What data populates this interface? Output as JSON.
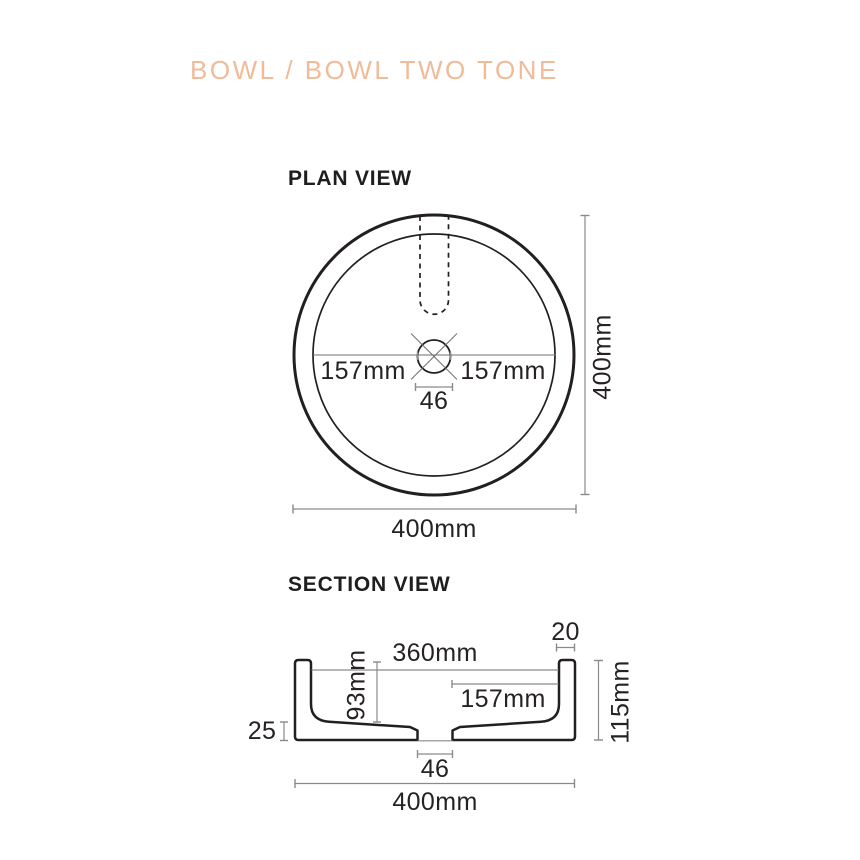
{
  "title": "BOWL / BOWL TWO TONE",
  "plan": {
    "heading": "PLAN VIEW",
    "dims": {
      "radius_left": "157mm",
      "radius_right": "157mm",
      "drain_width": "46",
      "overall_height": "400mm",
      "overall_width": "400mm"
    }
  },
  "section": {
    "heading": "SECTION VIEW",
    "dims": {
      "rim_thickness": "20",
      "inner_width": "360mm",
      "center_to_wall": "157mm",
      "bowl_depth": "93mm",
      "overall_height": "115mm",
      "base_thickness": "25",
      "drain_width": "46",
      "overall_width": "400mm"
    }
  },
  "colors": {
    "title_accent": "#f1bb98",
    "drawing_line": "#231f20",
    "dimension_line": "#8a8a8a",
    "text": "#262223"
  }
}
